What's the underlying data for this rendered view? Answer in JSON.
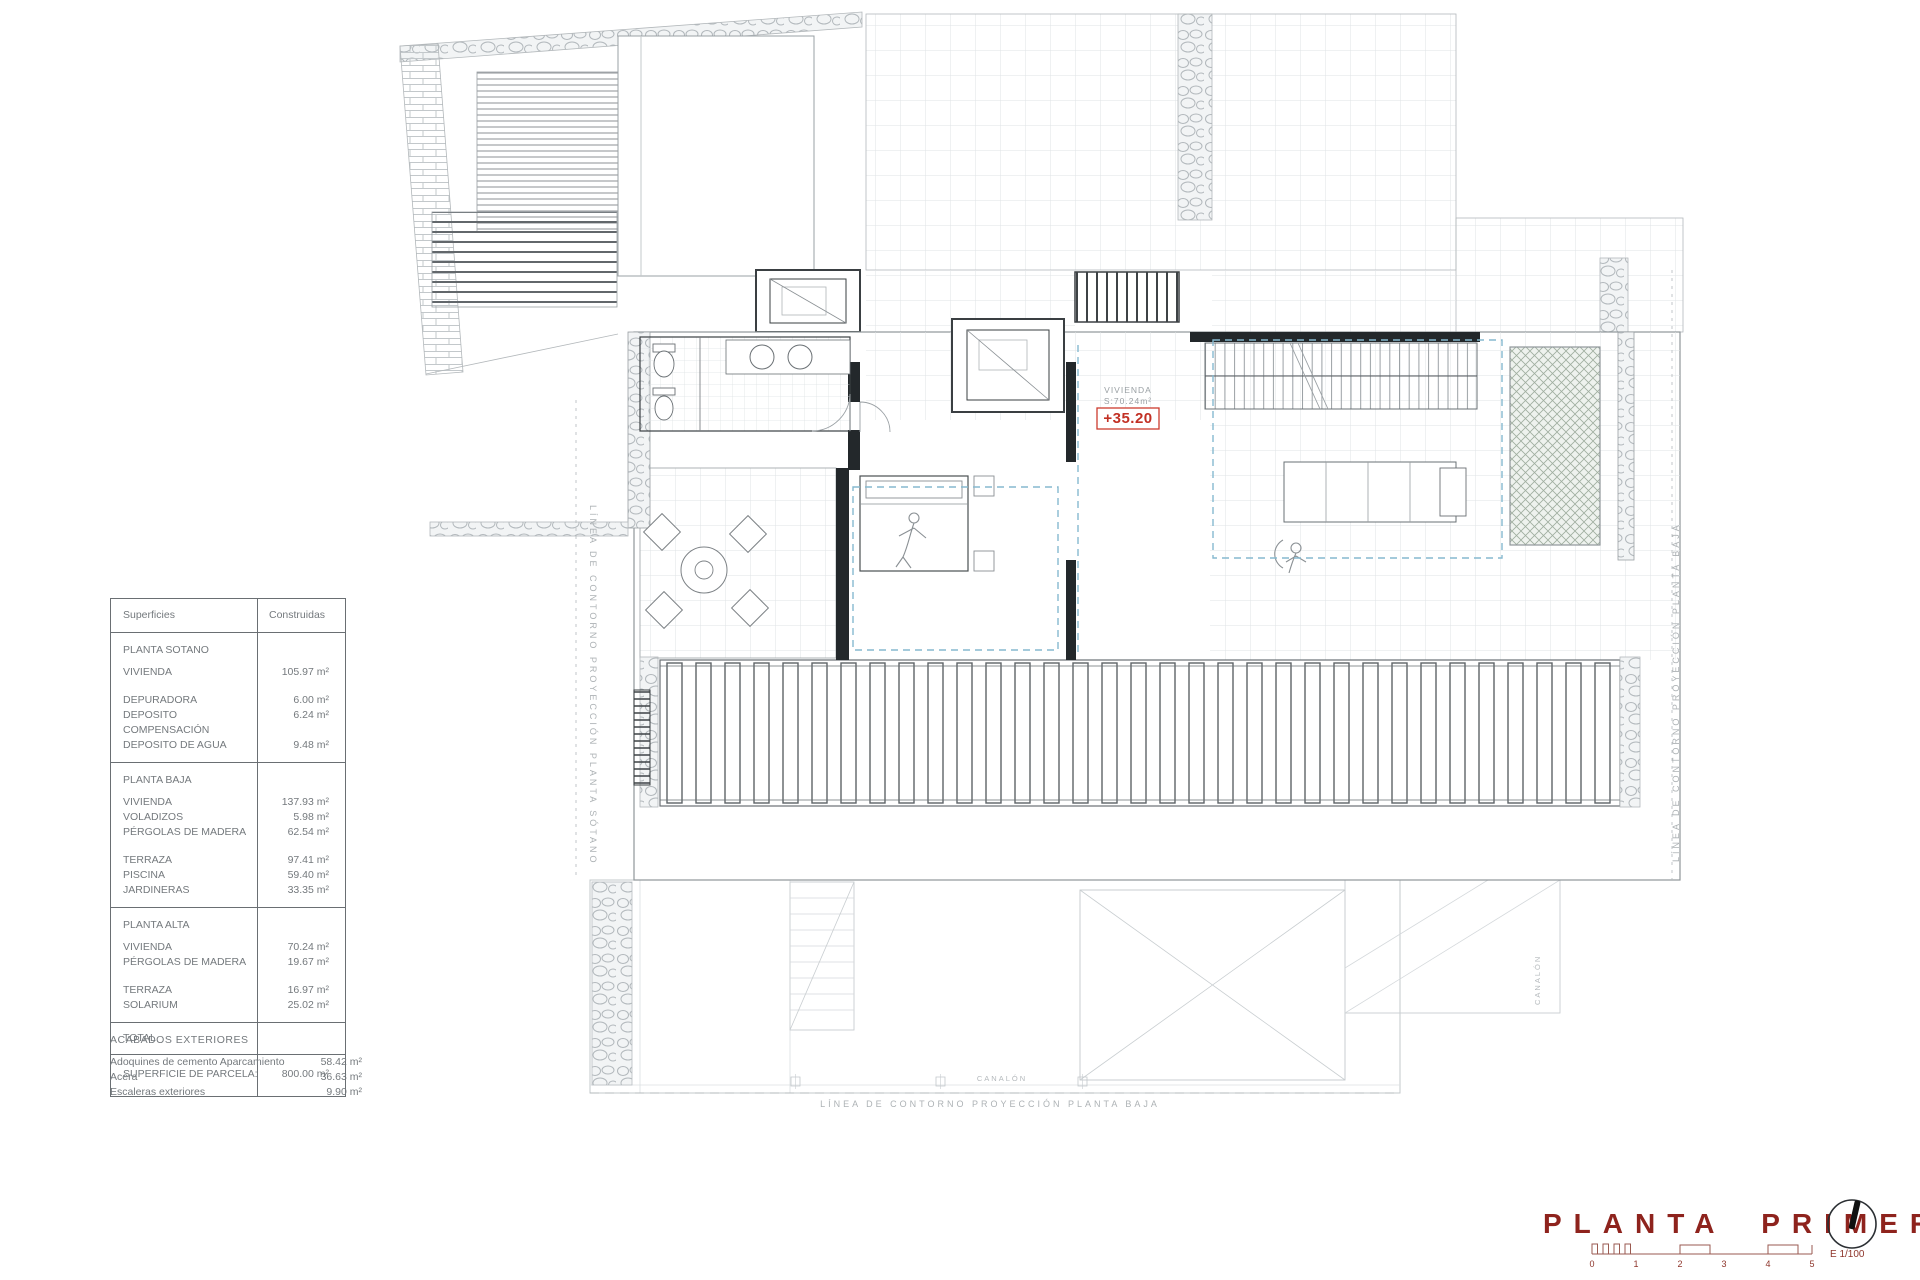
{
  "table": {
    "header_surfaces": "Superficies",
    "header_built": "Construidas",
    "sotano_title": "PLANTA SOTANO",
    "sotano_rows": [
      {
        "label": "VIVIENDA",
        "value": "105.97 m²"
      },
      {
        "label": "DEPURADORA",
        "value": "6.00 m²"
      },
      {
        "label": "DEPOSITO COMPENSACIÓN",
        "value": "6.24 m²"
      },
      {
        "label": "DEPOSITO DE AGUA",
        "value": "9.48 m²"
      }
    ],
    "baja_title": "PLANTA BAJA",
    "baja_rows": [
      {
        "label": "VIVIENDA",
        "value": "137.93 m²"
      },
      {
        "label": "VOLADIZOS",
        "value": "5.98 m²"
      },
      {
        "label": "PÉRGOLAS DE MADERA",
        "value": "62.54 m²"
      },
      {
        "label": "TERRAZA",
        "value": "97.41 m²"
      },
      {
        "label": "PISCINA",
        "value": "59.40 m²"
      },
      {
        "label": "JARDINERAS",
        "value": "33.35 m²"
      }
    ],
    "alta_title": "PLANTA ALTA",
    "alta_rows": [
      {
        "label": "VIVIENDA",
        "value": "70.24 m²"
      },
      {
        "label": "PÉRGOLAS DE MADERA",
        "value": "19.67 m²"
      },
      {
        "label": "TERRAZA",
        "value": "16.97 m²"
      },
      {
        "label": "SOLARIUM",
        "value": "25.02 m²"
      }
    ],
    "total_label": "TOTAL",
    "parcel_label": "SUPERFICIE DE PARCELA:",
    "parcel_value": "800.00 m²"
  },
  "finishes": {
    "title": "ACABADOS EXTERIORES",
    "rows": [
      {
        "label": "Adoquines de cemento Aparcamiento",
        "value": "58.42 m²"
      },
      {
        "label": "Acera",
        "value": "36.63 m²"
      },
      {
        "label": "Escaleras exteriores",
        "value": "9.90 m²"
      }
    ]
  },
  "plan": {
    "room_name": "VIVIENDA",
    "room_area": "S:70.24m²",
    "level_mark": "+35.20",
    "contour_left": "LÍNEA DE CONTORNO PROYECCIÓN PLANTA SÓTANO",
    "contour_right": "LÍNEA DE CONTORNO PROYECCIÓN PLANTA BAJA",
    "contour_bottom": "LÍNEA DE CONTORNO PROYECCIÓN PLANTA BAJA",
    "gutter_label": "CANALÓN"
  },
  "title_block": {
    "title": "PLANTA PRIMERA",
    "scale_label": "E 1/100",
    "ticks": [
      "0",
      "1",
      "2",
      "3",
      "4",
      "5"
    ]
  },
  "colors": {
    "accent_red": "#c23024",
    "title_red": "#8e231d",
    "projection_teal": "#86b9cf"
  }
}
